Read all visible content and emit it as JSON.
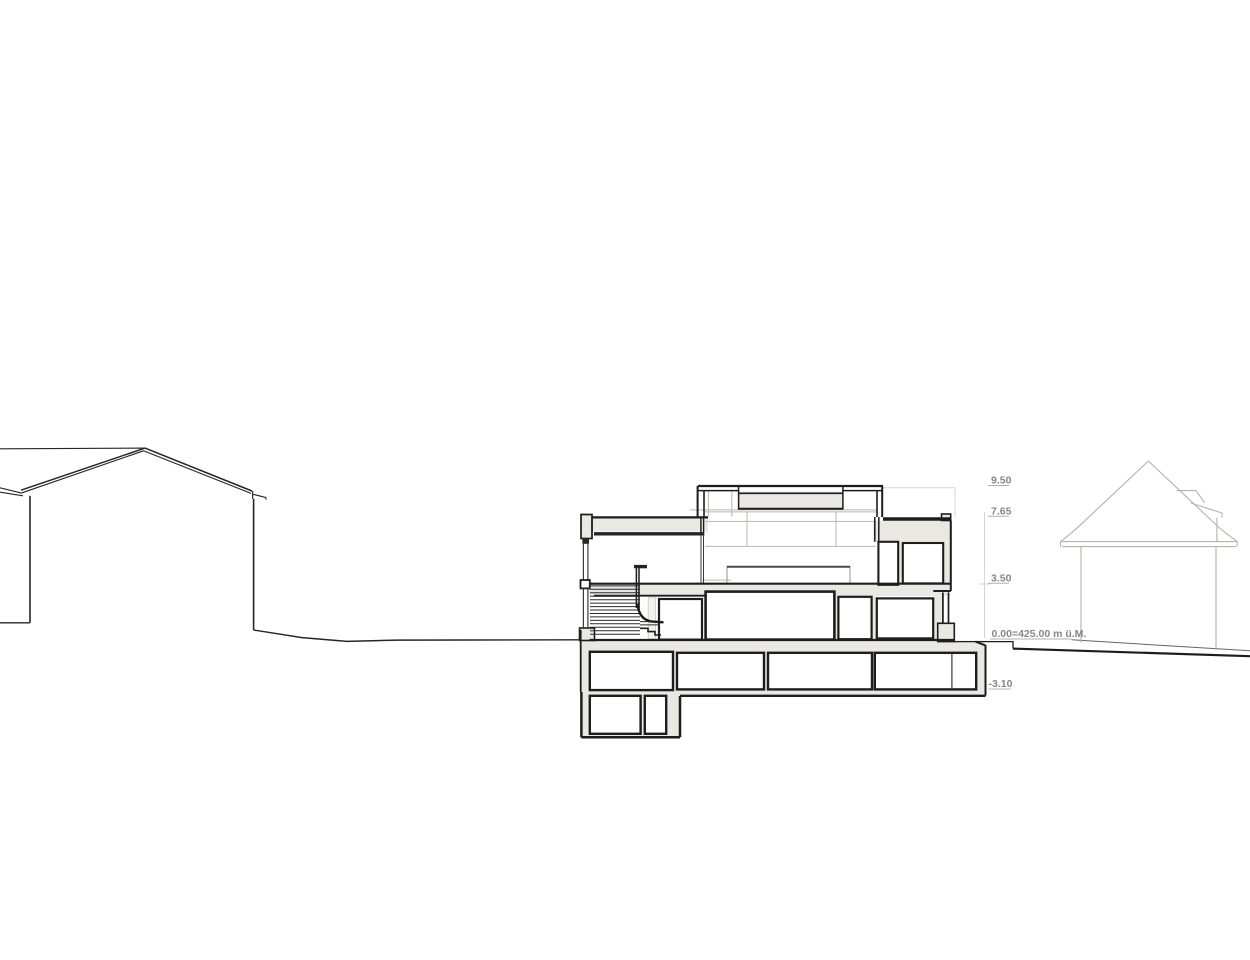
{
  "drawing": {
    "type": "architectural-cross-section",
    "levels": [
      {
        "id": "roof-upper",
        "label": "9.50"
      },
      {
        "id": "roof-lower",
        "label": "7.65"
      },
      {
        "id": "upper-floor",
        "label": "3.50"
      },
      {
        "id": "ground-floor",
        "label": "0.00=425.00 m ü.M."
      },
      {
        "id": "basement",
        "label": "-3.10"
      }
    ],
    "colors": {
      "wall_fill": "#e9e8e2",
      "outline": "#1d1d1d",
      "context_line": "#b3b2ae",
      "interior_line": "#b9b8b2",
      "label_text": "#868686",
      "label_line": "#b0b0af"
    }
  }
}
